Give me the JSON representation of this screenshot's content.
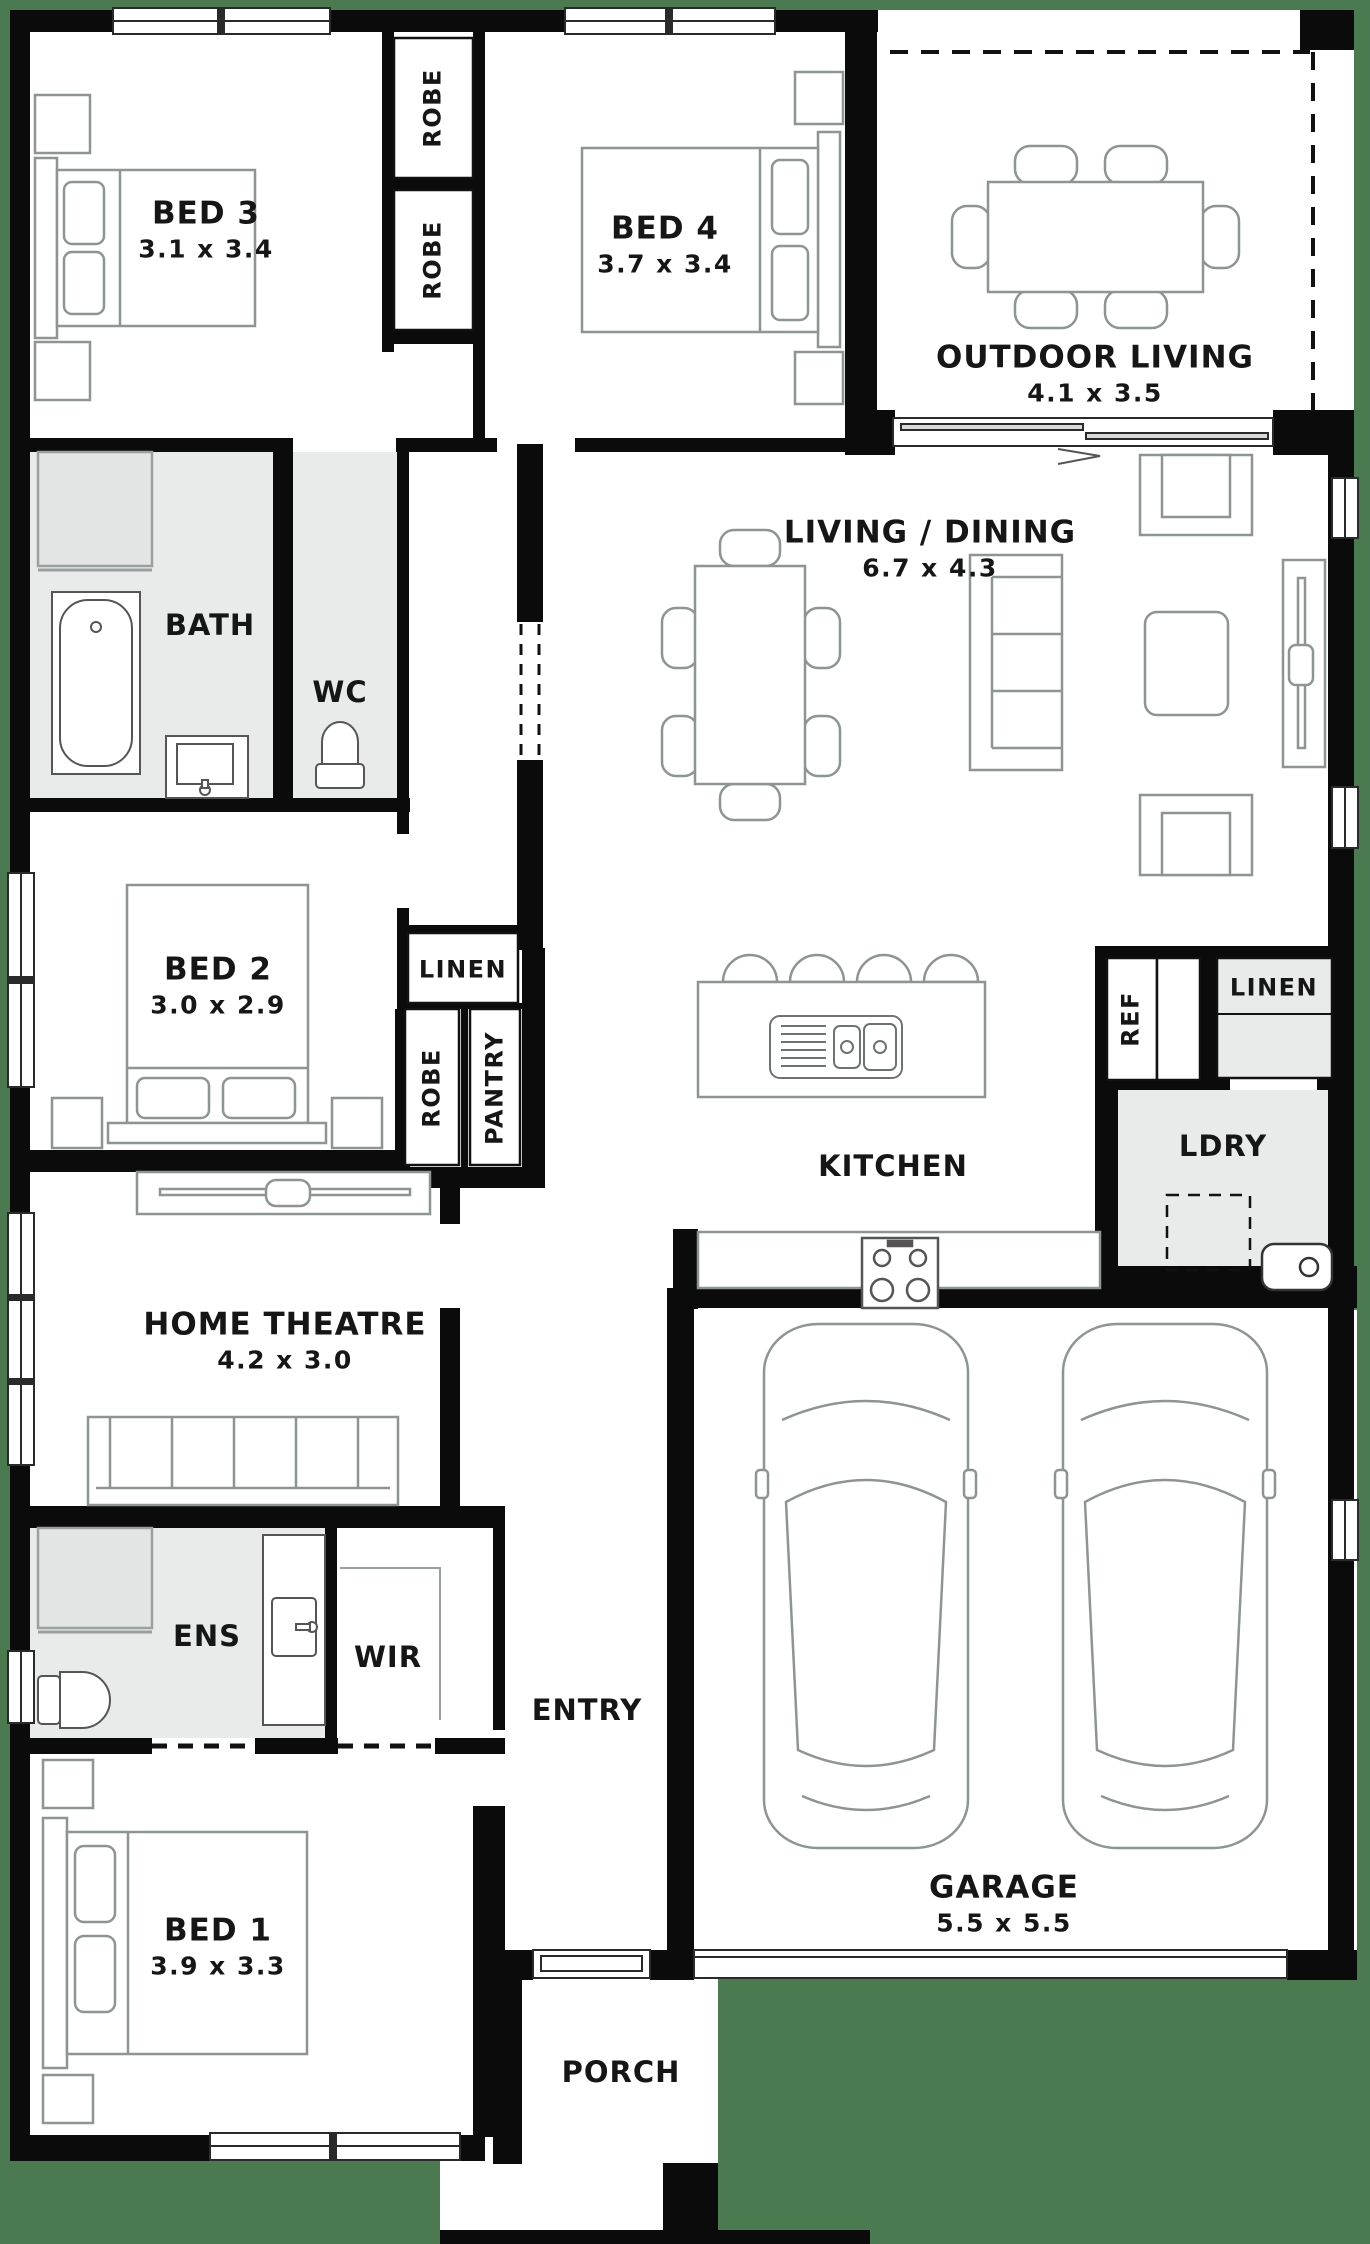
{
  "title": "Single storey house floor plan",
  "colors": {
    "background_green": "#4C7A50",
    "wall_black": "#0B0B0B",
    "wet_area_gray": "#E9EAEA",
    "furniture_gray": "#8E9494",
    "text": "#161616"
  },
  "rooms": [
    {
      "id": "bed-3",
      "label": "BED 3",
      "dims": "3.1 x 3.4",
      "x": 206,
      "y": 230,
      "size": "lg"
    },
    {
      "id": "robe-bed3-top",
      "label": "ROBE",
      "x": 433,
      "y": 108,
      "size": "sm",
      "rot": true
    },
    {
      "id": "robe-bed3-bottom",
      "label": "ROBE",
      "x": 433,
      "y": 260,
      "size": "sm",
      "rot": true
    },
    {
      "id": "bed-4",
      "label": "BED 4",
      "dims": "3.7 x 3.4",
      "x": 665,
      "y": 245,
      "size": "lg"
    },
    {
      "id": "outdoor-living",
      "label": "OUTDOOR LIVING",
      "dims": "4.1 x 3.5",
      "x": 1095,
      "y": 374,
      "size": "lg"
    },
    {
      "id": "bath",
      "label": "BATH",
      "x": 210,
      "y": 625,
      "size": "md"
    },
    {
      "id": "wc",
      "label": "WC",
      "x": 340,
      "y": 692,
      "size": "md"
    },
    {
      "id": "living-dining",
      "label": "LIVING / DINING",
      "dims": "6.7 x 4.3",
      "x": 930,
      "y": 549,
      "size": "lg"
    },
    {
      "id": "bed-2",
      "label": "BED 2",
      "dims": "3.0 x 2.9",
      "x": 218,
      "y": 986,
      "size": "lg"
    },
    {
      "id": "linen-hall",
      "label": "LINEN",
      "x": 463,
      "y": 970,
      "size": "sm"
    },
    {
      "id": "robe-bed2",
      "label": "ROBE",
      "x": 432,
      "y": 1088,
      "size": "sm",
      "rot": true
    },
    {
      "id": "pantry",
      "label": "PANTRY",
      "x": 495,
      "y": 1088,
      "size": "sm",
      "rot": true
    },
    {
      "id": "kitchen",
      "label": "KITCHEN",
      "x": 893,
      "y": 1166,
      "size": "md"
    },
    {
      "id": "ref",
      "label": "REF",
      "x": 1131,
      "y": 1019,
      "size": "sm",
      "rot": true
    },
    {
      "id": "linen-laundry",
      "label": "LINEN",
      "x": 1274,
      "y": 988,
      "size": "sm"
    },
    {
      "id": "ldry",
      "label": "LDRY",
      "x": 1223,
      "y": 1146,
      "size": "md"
    },
    {
      "id": "home-theatre",
      "label": "HOME THEATRE",
      "dims": "4.2 x 3.0",
      "x": 285,
      "y": 1341,
      "size": "lg"
    },
    {
      "id": "ens",
      "label": "ENS",
      "x": 207,
      "y": 1636,
      "size": "md"
    },
    {
      "id": "wir",
      "label": "WIR",
      "x": 388,
      "y": 1657,
      "size": "md"
    },
    {
      "id": "entry",
      "label": "ENTRY",
      "x": 587,
      "y": 1710,
      "size": "md"
    },
    {
      "id": "bed-1",
      "label": "BED 1",
      "dims": "3.9 x 3.3",
      "x": 218,
      "y": 1947,
      "size": "lg"
    },
    {
      "id": "garage",
      "label": "GARAGE",
      "dims": "5.5 x 5.5",
      "x": 1004,
      "y": 1904,
      "size": "lg"
    },
    {
      "id": "porch",
      "label": "PORCH",
      "x": 621,
      "y": 2072,
      "size": "md"
    }
  ]
}
